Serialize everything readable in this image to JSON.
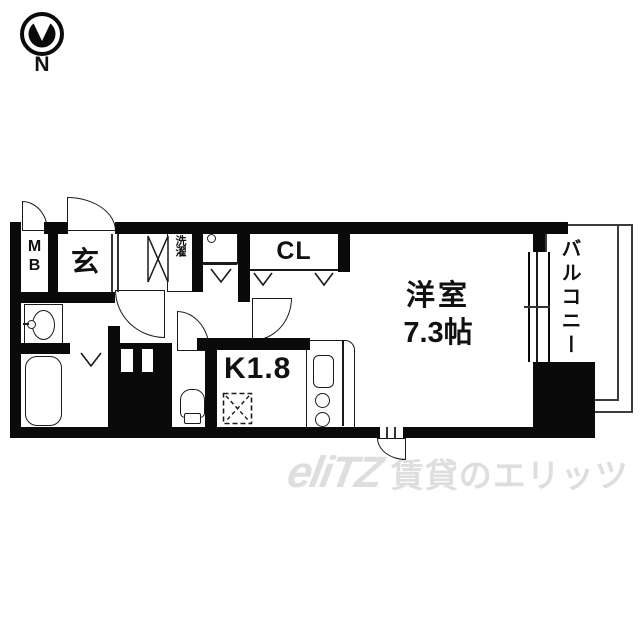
{
  "compass": {
    "north_label": "N"
  },
  "plan": {
    "meter_box_letters": [
      "M",
      "B"
    ],
    "entrance_label": "玄",
    "laundry_label": "洗濯",
    "closet_label": "CL",
    "kitchen_label": "K1.8",
    "main_room_label": "洋室",
    "main_room_size": "7.3帖",
    "balcony_label": "バルコニー"
  },
  "watermark": {
    "logo_text": "eliTZ",
    "brand_text": "賃貸のエリッツ"
  },
  "colors": {
    "wall": "#0a0a0a",
    "line": "#1a1a1a",
    "balcony_line": "#3c3c3c",
    "watermark": "#dedede",
    "background": "#ffffff"
  }
}
